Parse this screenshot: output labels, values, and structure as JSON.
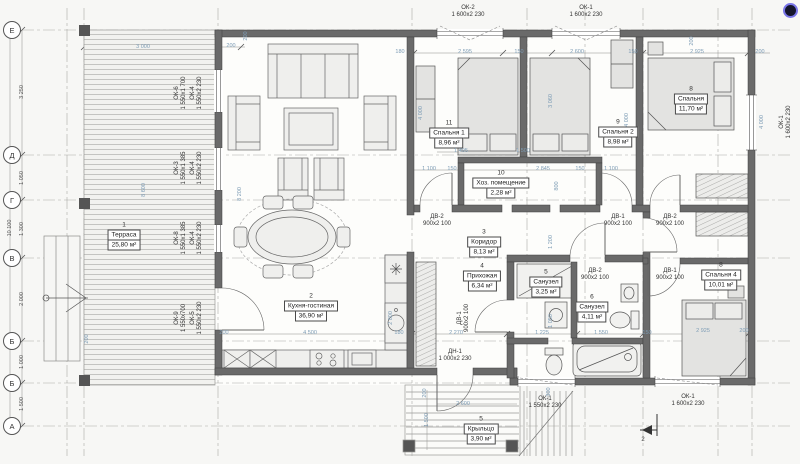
{
  "axes": {
    "items": [
      {
        "label": "Е",
        "y": 30
      },
      {
        "label": "Д",
        "y": 155
      },
      {
        "label": "Г",
        "y": 200
      },
      {
        "label": "В",
        "y": 258
      },
      {
        "label": "Б",
        "y": 341
      },
      {
        "label": "Б",
        "y": 383
      },
      {
        "label": "А",
        "y": 426
      }
    ],
    "segment_dims": [
      {
        "t": "3 250",
        "y": 92
      },
      {
        "t": "1 050",
        "y": 178
      },
      {
        "t": "1 300",
        "y": 229
      },
      {
        "t": "2 000",
        "y": 299
      },
      {
        "t": "1 000",
        "y": 362
      },
      {
        "t": "1 500",
        "y": 404
      }
    ],
    "total_dim": {
      "t": "10 100",
      "x": 10,
      "y": 228
    }
  },
  "rooms": [
    {
      "num": "1",
      "name": "Терраса",
      "area": "25,80 м²",
      "x": 124,
      "y": 236
    },
    {
      "num": "2",
      "name": "Кухня-гостиная",
      "area": "36,90 м²",
      "x": 311,
      "y": 307
    },
    {
      "num": "3",
      "name": "Коридор",
      "area": "8,13 м²",
      "x": 484,
      "y": 243
    },
    {
      "num": "4",
      "name": "Прихожая",
      "area": "6,34 м²",
      "x": 482,
      "y": 277
    },
    {
      "num": "5",
      "name": "Санузел",
      "area": "3,25 м²",
      "x": 546,
      "y": 283
    },
    {
      "num": "6",
      "name": "Санузел",
      "area": "4,11 м²",
      "x": 592,
      "y": 308
    },
    {
      "num": "8",
      "name": "Спальня 4",
      "area": "10,01 м²",
      "x": 721,
      "y": 276
    },
    {
      "num": "8",
      "name": "Спальня",
      "area": "11,70 м²",
      "x": 691,
      "y": 100
    },
    {
      "num": "9",
      "name": "Спальня 2",
      "area": "8,98 м²",
      "x": 618,
      "y": 133
    },
    {
      "num": "10",
      "name": "Хоз. помещение",
      "area": "2,28 м²",
      "x": 501,
      "y": 184
    },
    {
      "num": "11",
      "name": "Спальня 1",
      "area": "8,96 м²",
      "x": 449,
      "y": 134
    },
    {
      "num": "5",
      "name": "Крыльцо",
      "area": "3,90 м²",
      "x": 481,
      "y": 430
    }
  ],
  "window_tags": [
    {
      "l1": "ОК-2",
      "l2": "1 600x2 230",
      "x": 468,
      "y": 12,
      "v": 0
    },
    {
      "l1": "ОК-1",
      "l2": "1 600x2 230",
      "x": 586,
      "y": 12,
      "v": 0
    },
    {
      "l1": "ОК-1",
      "l2": "1 600x2 230",
      "x": 786,
      "y": 122,
      "v": 1
    },
    {
      "l1": "ДН-1",
      "l2": "1 000x2 230",
      "x": 455,
      "y": 356,
      "v": 0
    },
    {
      "l1": "ОК-1",
      "l2": "1 550x2 230",
      "x": 545,
      "y": 403,
      "v": 0
    },
    {
      "l1": "ОК-1",
      "l2": "1 600x2 230",
      "x": 688,
      "y": 401,
      "v": 0
    },
    {
      "l1": "ОК-6",
      "l2": "1 550x1 700",
      "x": 181,
      "y": 93,
      "v": 1
    },
    {
      "l1": "ОК-4",
      "l2": "1 550x2 230",
      "x": 197,
      "y": 93,
      "v": 1
    },
    {
      "l1": "ОК-3",
      "l2": "1 550x1 385",
      "x": 181,
      "y": 168,
      "v": 1
    },
    {
      "l1": "ОК-4",
      "l2": "1 550x2 230",
      "x": 197,
      "y": 168,
      "v": 1
    },
    {
      "l1": "ОК-8",
      "l2": "1 550x1 385",
      "x": 181,
      "y": 238,
      "v": 1
    },
    {
      "l1": "ОК-4",
      "l2": "1 550x2 230",
      "x": 197,
      "y": 238,
      "v": 1
    },
    {
      "l1": "ОК-9",
      "l2": "1 550x700",
      "x": 181,
      "y": 318,
      "v": 1
    },
    {
      "l1": "ОК-5",
      "l2": "1 550x2 230",
      "x": 197,
      "y": 318,
      "v": 1
    }
  ],
  "door_tags": [
    {
      "l1": "ДВ-2",
      "l2": "900x2 100",
      "x": 437,
      "y": 221,
      "v": 0
    },
    {
      "l1": "ДВ-1",
      "l2": "900x2 100",
      "x": 618,
      "y": 221,
      "v": 0
    },
    {
      "l1": "ДВ-2",
      "l2": "900x2 100",
      "x": 670,
      "y": 221,
      "v": 0
    },
    {
      "l1": "ДВ-2",
      "l2": "900x2 100",
      "x": 595,
      "y": 275,
      "v": 0
    },
    {
      "l1": "ДВ-1",
      "l2": "900x2 100",
      "x": 670,
      "y": 275,
      "v": 0
    },
    {
      "l1": "ДВ-1",
      "l2": "900x2 100",
      "x": 464,
      "y": 318,
      "v": 1
    }
  ],
  "dims": [
    {
      "t": "3 000",
      "x": 143,
      "y": 47,
      "v": 0
    },
    {
      "t": "200",
      "x": 231,
      "y": 46,
      "v": 0
    },
    {
      "t": "200",
      "x": 246,
      "y": 36,
      "v": 1
    },
    {
      "t": "180",
      "x": 400,
      "y": 52,
      "v": 0
    },
    {
      "t": "2 595",
      "x": 465,
      "y": 52,
      "v": 0
    },
    {
      "t": "150",
      "x": 519,
      "y": 52,
      "v": 0
    },
    {
      "t": "2 600",
      "x": 577,
      "y": 52,
      "v": 0
    },
    {
      "t": "150",
      "x": 633,
      "y": 52,
      "v": 0
    },
    {
      "t": "2 925",
      "x": 697,
      "y": 52,
      "v": 0
    },
    {
      "t": "200",
      "x": 760,
      "y": 52,
      "v": 0
    },
    {
      "t": "200",
      "x": 692,
      "y": 41,
      "v": 1
    },
    {
      "t": "4 000",
      "x": 421,
      "y": 113,
      "v": 1
    },
    {
      "t": "3 060",
      "x": 551,
      "y": 101,
      "v": 1
    },
    {
      "t": "4 000",
      "x": 627,
      "y": 120,
      "v": 1
    },
    {
      "t": "4 000",
      "x": 762,
      "y": 122,
      "v": 1
    },
    {
      "t": "1 495",
      "x": 461,
      "y": 151,
      "v": 0
    },
    {
      "t": "1 500",
      "x": 523,
      "y": 151,
      "v": 0
    },
    {
      "t": "1 100",
      "x": 429,
      "y": 169,
      "v": 0
    },
    {
      "t": "150",
      "x": 452,
      "y": 169,
      "v": 0
    },
    {
      "t": "2 845",
      "x": 543,
      "y": 169,
      "v": 0
    },
    {
      "t": "150",
      "x": 580,
      "y": 169,
      "v": 0
    },
    {
      "t": "1 100",
      "x": 611,
      "y": 169,
      "v": 0
    },
    {
      "t": "800",
      "x": 557,
      "y": 186,
      "v": 1
    },
    {
      "t": "8 600",
      "x": 144,
      "y": 190,
      "v": 1
    },
    {
      "t": "8 200",
      "x": 240,
      "y": 194,
      "v": 1
    },
    {
      "t": "1 200",
      "x": 551,
      "y": 242,
      "v": 1
    },
    {
      "t": "1 050",
      "x": 551,
      "y": 321,
      "v": 1
    },
    {
      "t": "200",
      "x": 224,
      "y": 333,
      "v": 0
    },
    {
      "t": "4 500",
      "x": 310,
      "y": 333,
      "v": 0
    },
    {
      "t": "180",
      "x": 399,
      "y": 333,
      "v": 0
    },
    {
      "t": "2 270",
      "x": 456,
      "y": 333,
      "v": 0
    },
    {
      "t": "1 225",
      "x": 542,
      "y": 333,
      "v": 0
    },
    {
      "t": "1 550",
      "x": 601,
      "y": 333,
      "v": 0
    },
    {
      "t": "150",
      "x": 647,
      "y": 333,
      "v": 0
    },
    {
      "t": "2 925",
      "x": 703,
      "y": 331,
      "v": 0
    },
    {
      "t": "200",
      "x": 744,
      "y": 331,
      "v": 0
    },
    {
      "t": "2 800",
      "x": 391,
      "y": 318,
      "v": 1
    },
    {
      "t": "200",
      "x": 87,
      "y": 339,
      "v": 1
    },
    {
      "t": "200",
      "x": 425,
      "y": 393,
      "v": 1
    },
    {
      "t": "1 500",
      "x": 427,
      "y": 420,
      "v": 1
    },
    {
      "t": "2 600",
      "x": 463,
      "y": 404,
      "v": 0
    },
    {
      "t": "300",
      "x": 549,
      "y": 392,
      "v": 1
    }
  ],
  "section_marker": {
    "label": "2"
  },
  "colors": {
    "wall": "#6a6a6a",
    "dim_text": "#7d9cb5",
    "line": "#4d4d4d",
    "badge_ring": "#7a76e8"
  }
}
